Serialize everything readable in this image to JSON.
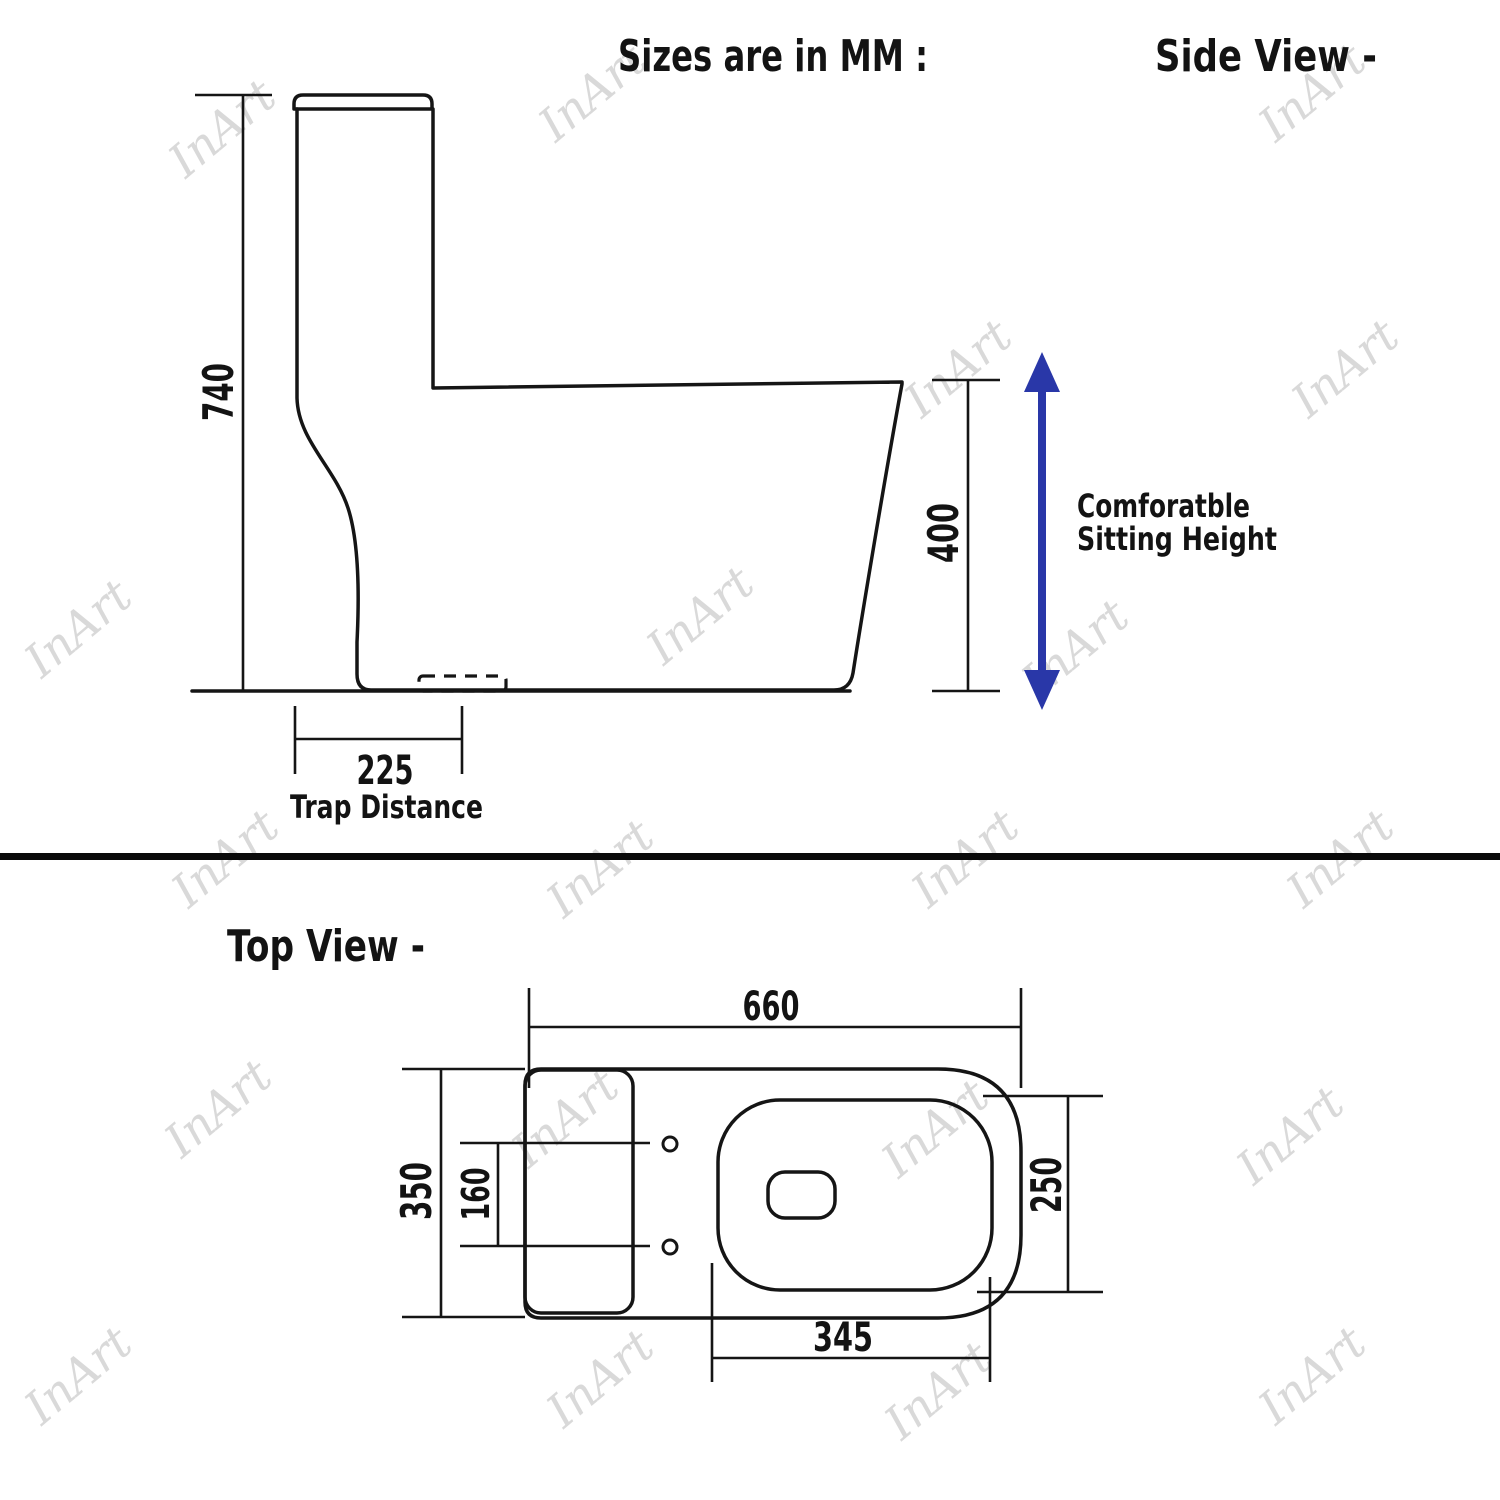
{
  "page": {
    "background": "#ffffff",
    "line_color": "#151515",
    "accent_blue": "#2937a8",
    "watermark_color": "#d9d9d9"
  },
  "headers": {
    "sizes_note": "Sizes are in MM :",
    "side_view": "Side View -",
    "top_view": "Top View -"
  },
  "side_view": {
    "total_height": "740",
    "sitting_height": "400",
    "comfort_note_1": "Comforatble",
    "comfort_note_2": "Sitting Height",
    "trap_distance_value": "225",
    "trap_distance_label": "Trap Distance"
  },
  "top_view": {
    "length": "660",
    "width": "350",
    "hole_spacing": "160",
    "seat_width": "250",
    "seat_length": "345"
  },
  "watermarks": {
    "text": "InArt",
    "positions": [
      [
        222,
        128
      ],
      [
        592,
        92
      ],
      [
        1312,
        92
      ],
      [
        958,
        368
      ],
      [
        1345,
        368
      ],
      [
        78,
        628
      ],
      [
        700,
        615
      ],
      [
        1075,
        648
      ],
      [
        225,
        858
      ],
      [
        600,
        868
      ],
      [
        965,
        858
      ],
      [
        1340,
        858
      ],
      [
        218,
        1108
      ],
      [
        565,
        1118
      ],
      [
        935,
        1128
      ],
      [
        1290,
        1135
      ],
      [
        78,
        1375
      ],
      [
        600,
        1378
      ],
      [
        938,
        1390
      ],
      [
        1312,
        1375
      ]
    ]
  }
}
